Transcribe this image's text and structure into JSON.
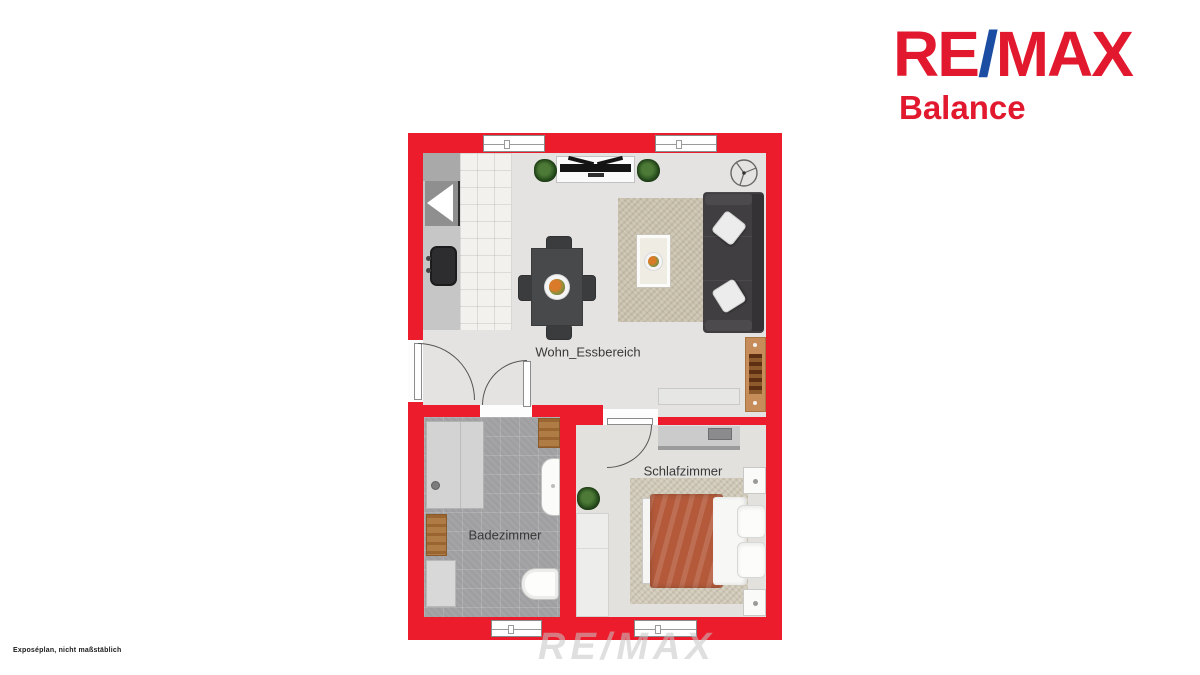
{
  "branding": {
    "re": "RE",
    "slash": "/",
    "max": "MAX",
    "office": "Balance",
    "red": "#e1182e",
    "blue": "#1b4ea3"
  },
  "floorplan": {
    "wall_color": "#ec1c2c",
    "rooms": [
      {
        "id": "living-dining",
        "label": "Wohn_Essbereich"
      },
      {
        "id": "bathroom",
        "label": "Badezimmer"
      },
      {
        "id": "bedroom",
        "label": "Schlafzimmer"
      }
    ],
    "furniture_icons": [
      "kitchen-counter",
      "fridge",
      "stove",
      "kitchen-sink",
      "dining-table",
      "dining-chair",
      "fruit-bowl",
      "tv-lowboard",
      "tv",
      "potted-plant",
      "ceiling-fan",
      "area-rug",
      "coffee-table",
      "sofa",
      "throw-pillow",
      "drawer-dresser",
      "sideboard",
      "shower",
      "bath-mat",
      "washbasin",
      "bathtub",
      "washing-machine",
      "desk",
      "laptop",
      "double-bed",
      "duvet",
      "bed-pillow",
      "nightstand",
      "wardrobe",
      "window",
      "door-swing"
    ],
    "colors": {
      "living_floor": "#e4e3e1",
      "bath_floor": "#a4a4a7",
      "bedroom_floor": "#e2e1de",
      "duvet": "#b45a3b",
      "wood": "#c68c5a"
    }
  },
  "watermark": {
    "text": "RE/MAX"
  },
  "footer": {
    "disclaimer": "Exposéplan, nicht maßstäblich"
  }
}
